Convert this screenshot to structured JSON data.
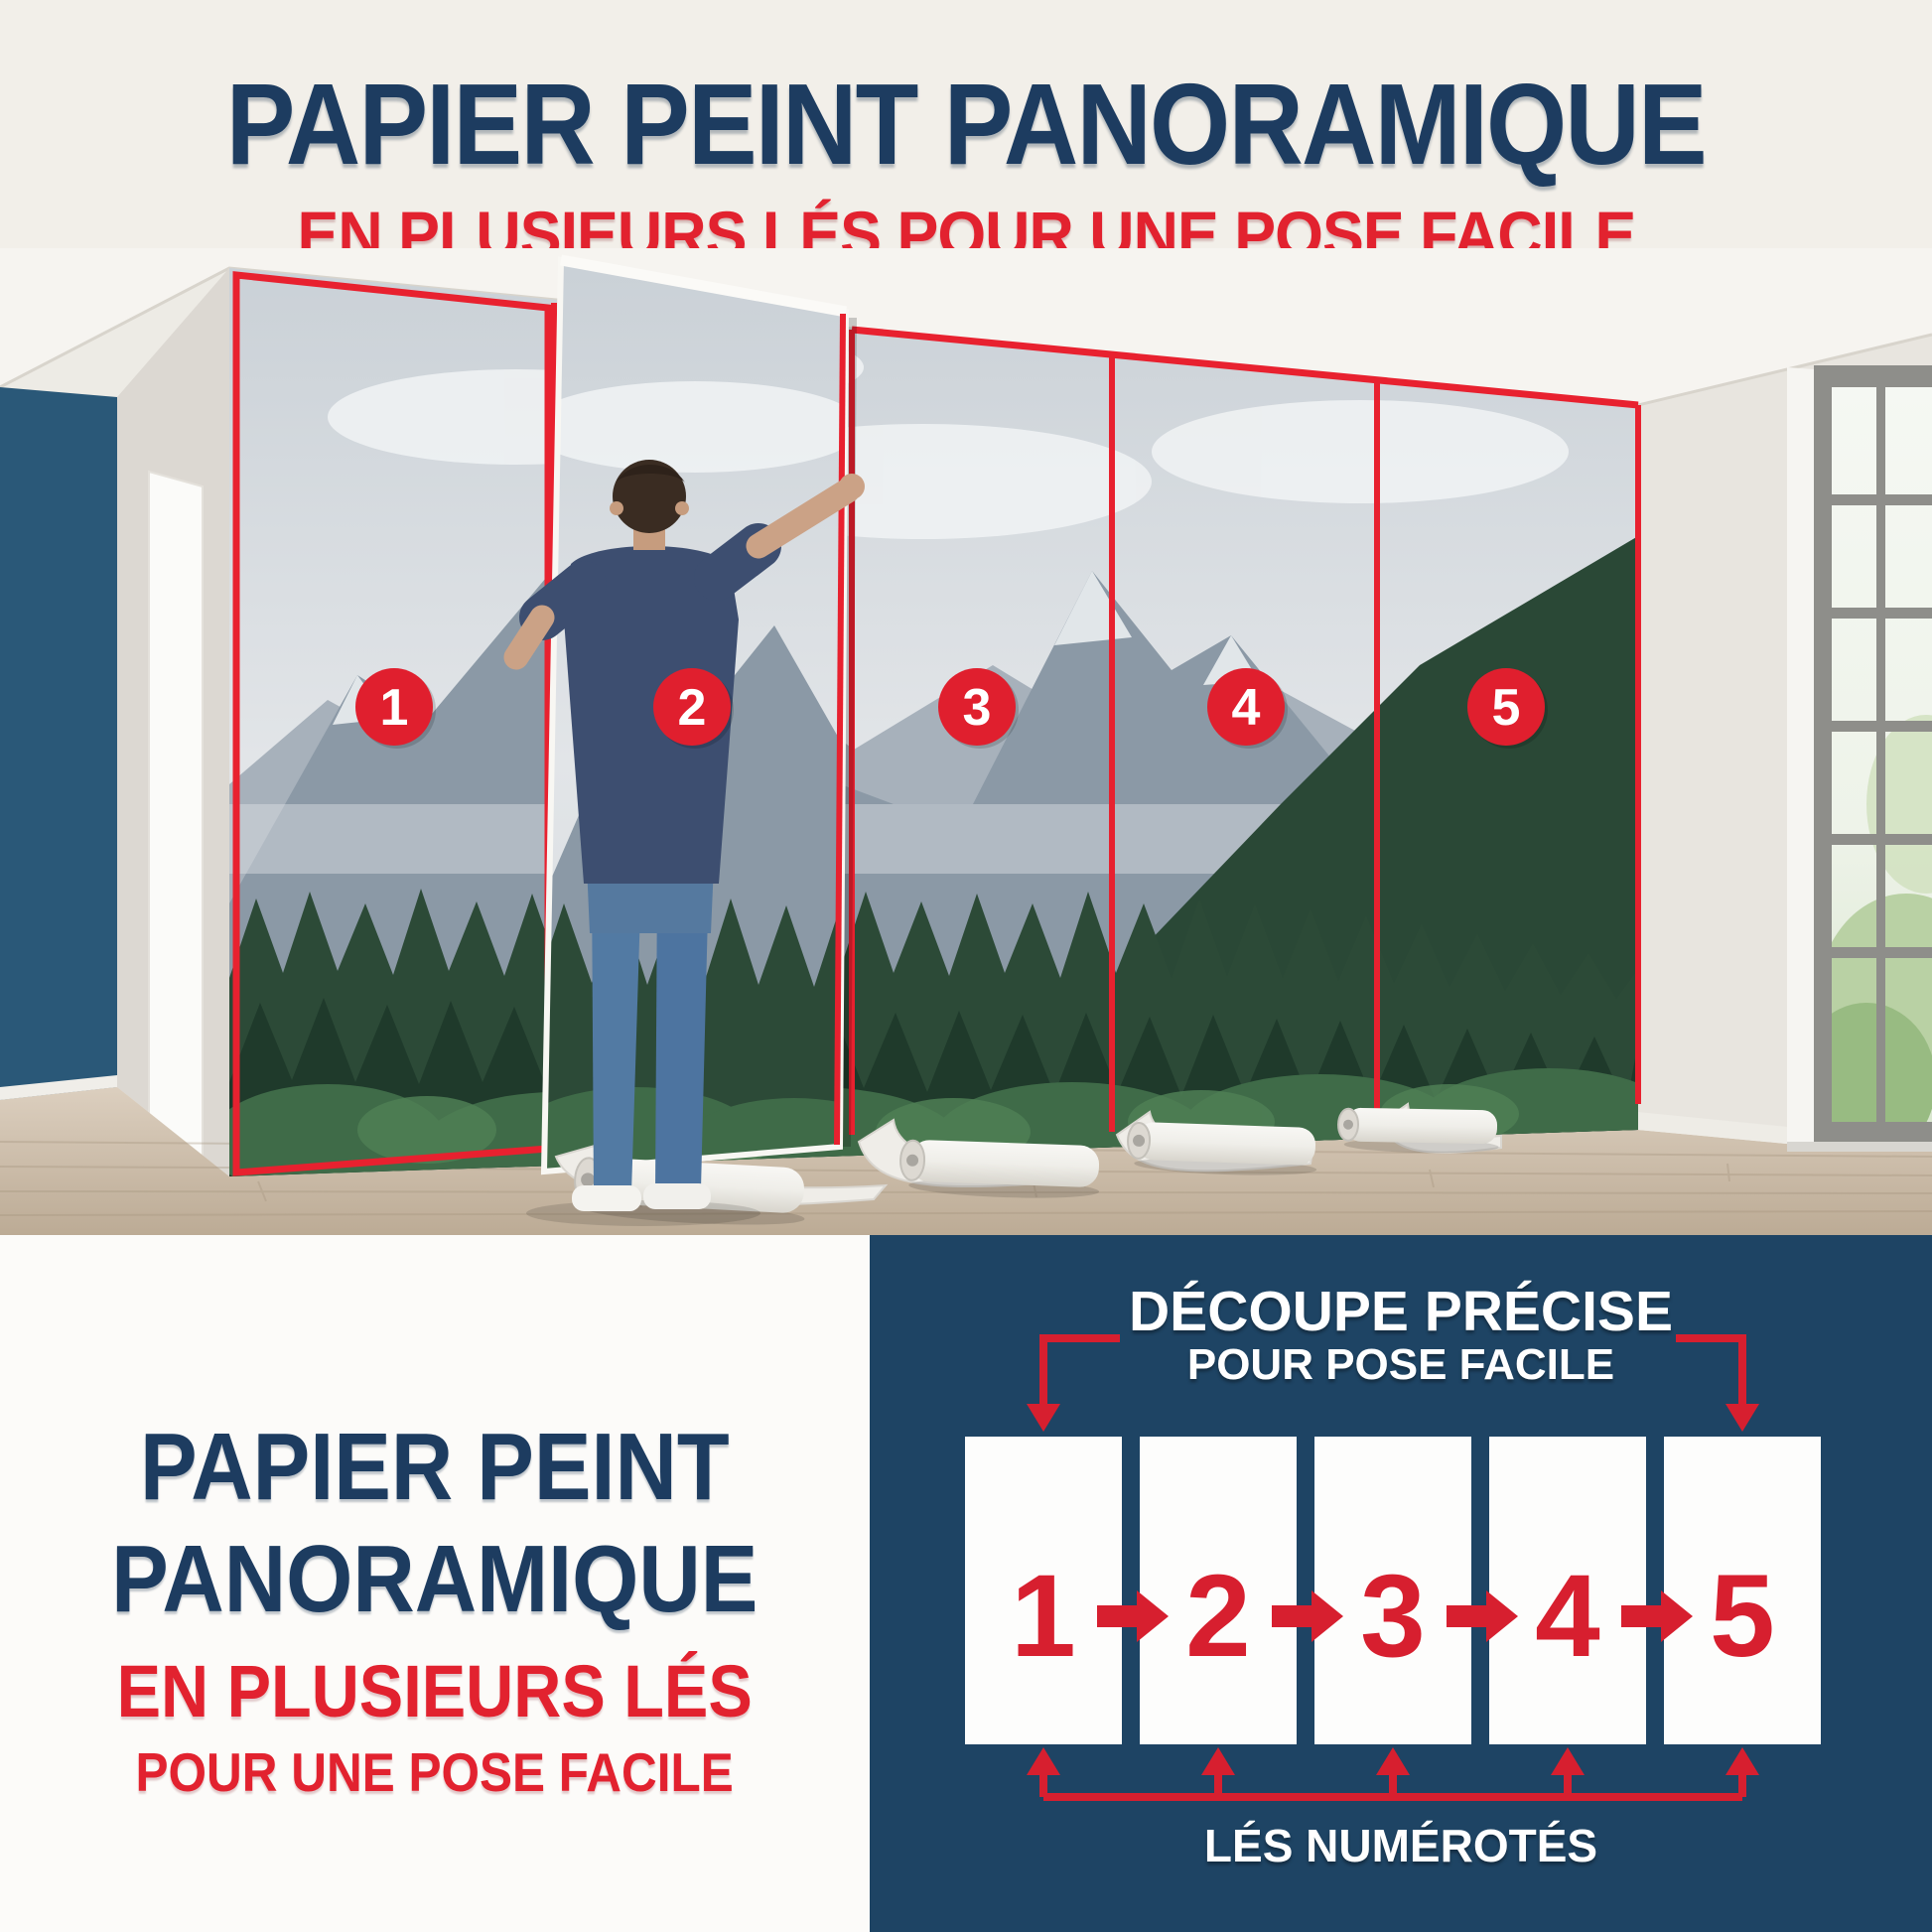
{
  "colors": {
    "navy_text": "#1d3c60",
    "red_accent": "#e2222f",
    "diagram_navy": "#1e4464",
    "diagram_red": "#d71f2f",
    "badge_red": "#e01f2e"
  },
  "header": {
    "title": "PAPIER PEINT PANORAMIQUE",
    "subtitle": "EN PLUSIEURS LÉS POUR UNE POSE FACILE"
  },
  "photo": {
    "badges": [
      "1",
      "2",
      "3",
      "4",
      "5"
    ]
  },
  "bottom_left": {
    "title_line1": "PAPIER PEINT",
    "title_line2": "PANORAMIQUE",
    "subtitle_line1": "EN PLUSIEURS LÉS",
    "subtitle_line2": "POUR UNE POSE FACILE"
  },
  "diagram": {
    "heading_line1": "DÉCOUPE PRÉCISE",
    "heading_line2": "POUR POSE FACILE",
    "strip_numbers": [
      "1",
      "2",
      "3",
      "4",
      "5"
    ],
    "footer_label": "LÉS NUMÉROTÉS"
  }
}
